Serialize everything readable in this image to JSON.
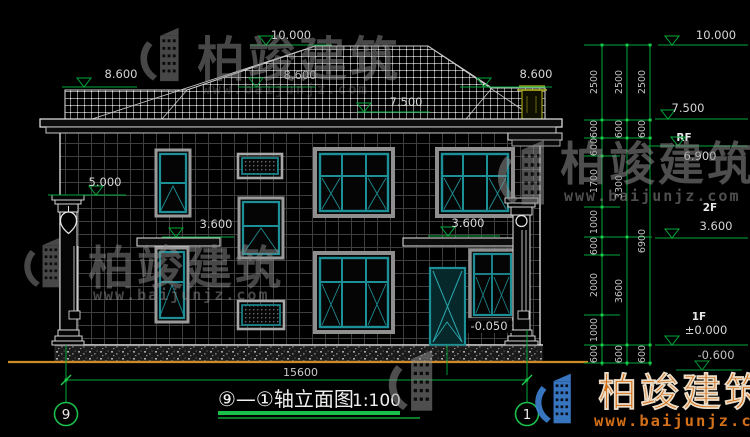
{
  "watermark": {
    "brand": "柏竣建筑",
    "url": "www.baijunjz.com"
  },
  "title_block": {
    "label": "⑨—①轴立面图",
    "scale": "1:100"
  },
  "axes": {
    "left": "9",
    "right": "1"
  },
  "levels": {
    "ridge": "10.000",
    "roof_left": "8.600",
    "roof_mid": "8.600",
    "roof_right": "8.600",
    "eave": "7.500",
    "porch_top": "5.000",
    "canopy_left": "3.600",
    "canopy_right": "3.600",
    "entrance": "-0.050"
  },
  "dims": {
    "total_width": "15600",
    "right": {
      "lv10": "10.000",
      "lv75": "7.500",
      "rf": "RF",
      "lv69": "6.900",
      "f2": "2F",
      "lv36": "3.600",
      "f1": "1F",
      "lv0": "±0.000",
      "ground": "-0.600",
      "chain1": [
        "2500",
        "600",
        "600",
        "1700",
        "1000",
        "600",
        "2000",
        "1000",
        "600"
      ],
      "chain2": [
        "2500",
        "600",
        "3300",
        "3600",
        "600"
      ],
      "chain3": [
        "2500",
        "600",
        "6900",
        "600"
      ]
    }
  },
  "colors": {
    "dim_green": "#00a83a",
    "bright_green": "#19d04a",
    "window_teal": "#1d8f96",
    "ground_orange": "#cf8a28",
    "wm_gray": "#8e8e8e",
    "wm_orange": "#e0761a",
    "wm_blue": "#3d7fd0"
  }
}
